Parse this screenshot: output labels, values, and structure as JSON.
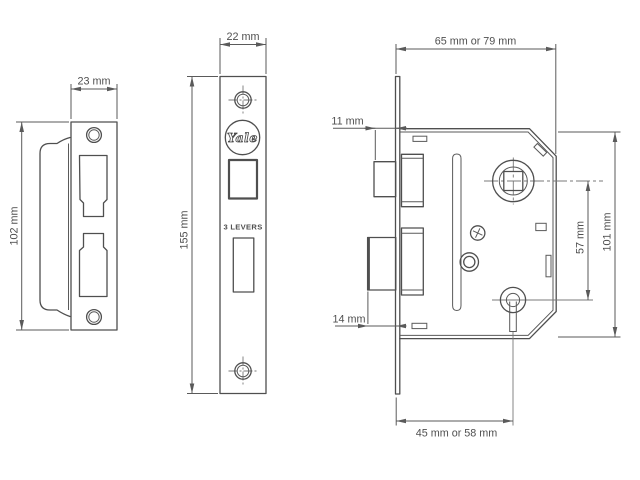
{
  "diagram": {
    "background": "#ffffff",
    "line_color": "#4f4f4f",
    "strike_plate": {
      "width_label": "23 mm",
      "height_label": "102 mm"
    },
    "faceplate": {
      "width_label": "22 mm",
      "height_label": "155 mm",
      "brand": "Yale",
      "levers_label": "3 LEVERS"
    },
    "lock_body": {
      "case_depth_label": "65 mm or 79 mm",
      "latch_projection_label": "11 mm",
      "bolt_projection_label": "14 mm",
      "centres_label": "57 mm",
      "case_height_label": "101 mm",
      "backset_label": "45 mm or 58 mm"
    }
  }
}
